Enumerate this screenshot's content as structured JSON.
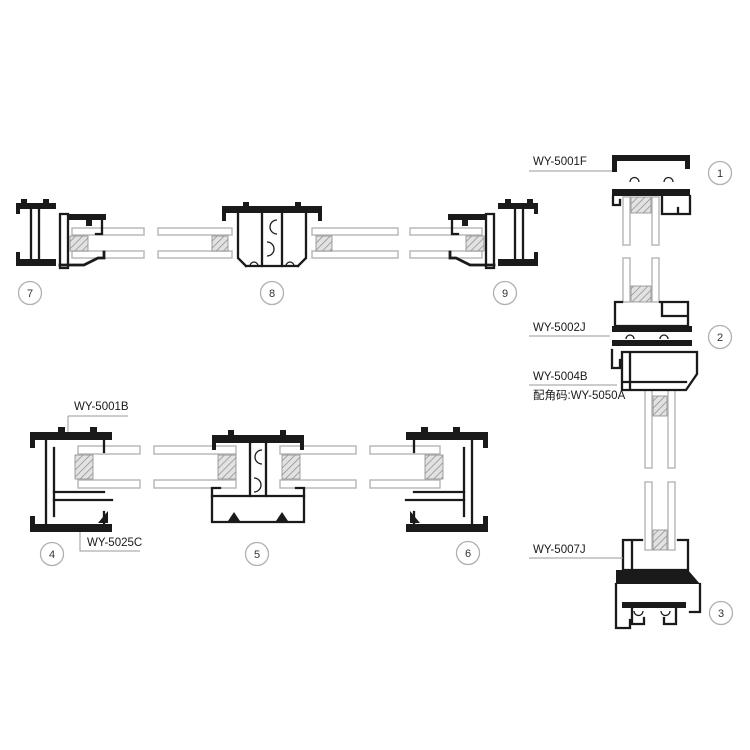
{
  "diagram": {
    "background_color": "#ffffff",
    "line_color": "#1a1a1a",
    "glass_color": "#b5b5b5",
    "spacer_hatch_color": "#8a8a8a",
    "balloon_ring_color": "#b0b0b0",
    "callouts": {
      "head_profile": "WY-5001F",
      "transom_profile": "WY-5002J",
      "transom_lower_profile": "WY-5004B",
      "corner_connector_code": "配角码:WY-5050A",
      "sill_sash_profile": "WY-5007J",
      "jamb_frame_profile": "WY-5001B",
      "jamb_sash_profile": "WY-5025C"
    },
    "balloons": [
      "1",
      "2",
      "3",
      "4",
      "5",
      "6",
      "7",
      "8",
      "9"
    ]
  }
}
